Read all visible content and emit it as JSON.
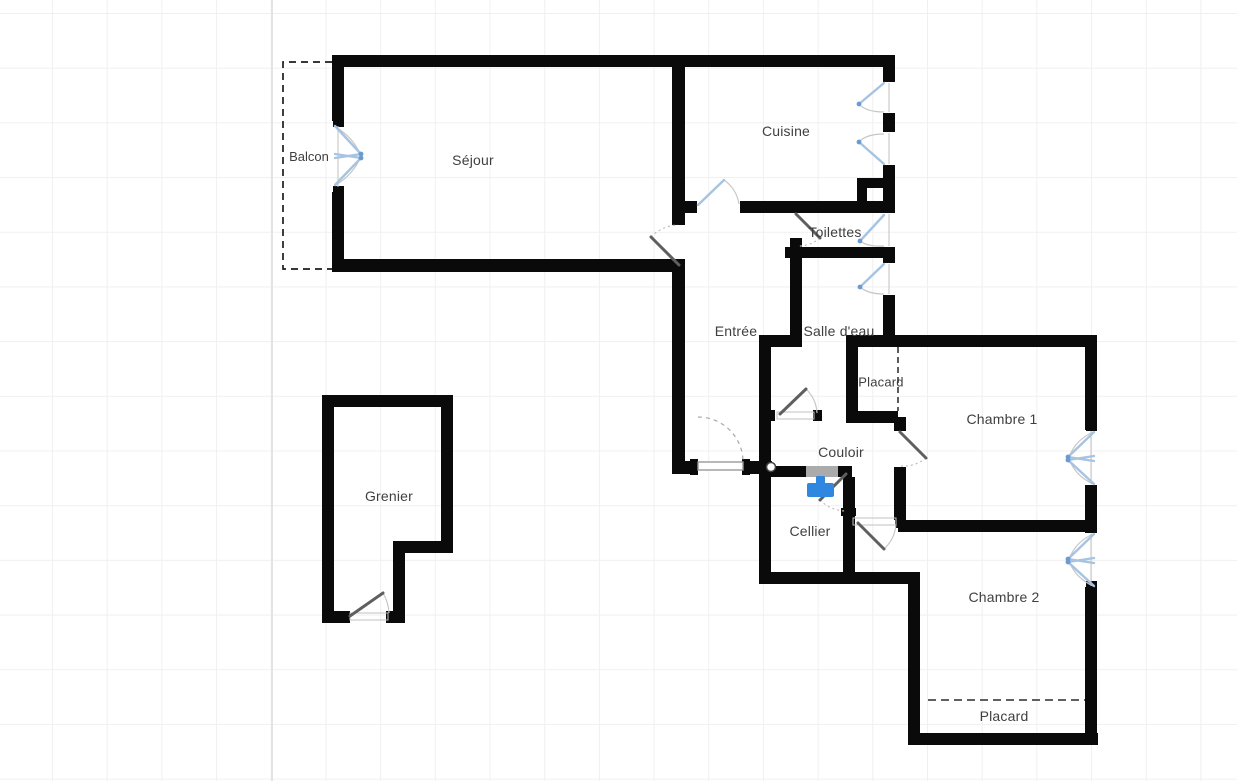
{
  "canvas": {
    "width": 1237,
    "height": 781,
    "background": "#ffffff",
    "grid_size_px": 55
  },
  "colors": {
    "wall": "#0a0a0a",
    "window_symbol": "#a6c4e2",
    "door_leaf": "#5f5f5f",
    "swing_arc": "#c6c6c6",
    "wall_opening": "#ababab",
    "water_heater": "#2f87e0",
    "label_text": "#3f3f3f",
    "grid_line": "#f0f0f0"
  },
  "rooms": {
    "balcon": {
      "label": "Balcon"
    },
    "sejour": {
      "label": "Séjour"
    },
    "cuisine": {
      "label": "Cuisine"
    },
    "toilettes": {
      "label": "Toilettes"
    },
    "entree": {
      "label": "Entrée"
    },
    "salle_deau": {
      "label": "Salle d'eau"
    },
    "placard_1": {
      "label": "Placard"
    },
    "chambre_1": {
      "label": "Chambre 1"
    },
    "couloir": {
      "label": "Couloir"
    },
    "cellier": {
      "label": "Cellier"
    },
    "grenier": {
      "label": "Grenier"
    },
    "chambre_2": {
      "label": "Chambre 2"
    },
    "placard_2": {
      "label": "Placard"
    }
  },
  "fixtures": {
    "water_heater": {
      "icon": "water-heater-icon",
      "color": "#2f87e0",
      "room": "Cellier"
    }
  }
}
